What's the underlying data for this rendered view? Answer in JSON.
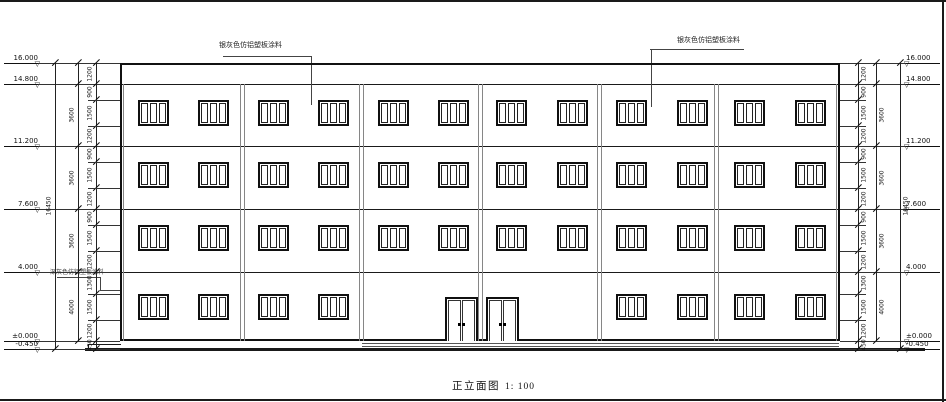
{
  "title": {
    "name": "正立面图",
    "scale": "1: 100"
  },
  "annotations": {
    "left": {
      "text": "银灰色仿铝塑板涂料"
    },
    "right": {
      "text": "银灰色仿铝塑板涂料"
    },
    "base": {
      "text": "深灰色仿铝塑板涂料"
    }
  },
  "colors": {
    "line": "#1a1a1a",
    "pilaster": "#868686",
    "ground": "#111111"
  },
  "levels_left": [
    {
      "label": "16.000",
      "y": 63
    },
    {
      "label": "14.800",
      "y": 84
    },
    {
      "label": "11.200",
      "y": 146
    },
    {
      "label": "7.600",
      "y": 209
    },
    {
      "label": "4.000",
      "y": 272
    },
    {
      "label": "±0.000",
      "y": 341
    },
    {
      "label": "-0.450",
      "y": 349
    }
  ],
  "levels_right": [
    {
      "label": "16.000",
      "y": 63
    },
    {
      "label": "14.800",
      "y": 84
    },
    {
      "label": "11.200",
      "y": 146
    },
    {
      "label": "7.600",
      "y": 209
    },
    {
      "label": "4.000",
      "y": 272
    },
    {
      "label": "±0.000",
      "y": 341
    },
    {
      "label": "-0.450",
      "y": 349
    }
  ],
  "dim_chains": [
    {
      "id": "left-inner",
      "side": "left",
      "x": 96,
      "ext": true,
      "bounds": [
        63,
        84,
        100,
        126,
        146,
        162,
        188,
        209,
        225,
        251,
        272,
        294,
        320,
        341,
        349
      ],
      "labels": [
        "1200",
        "900",
        "1500",
        "1200",
        "900",
        "1500",
        "1200",
        "900",
        "1500",
        "1200",
        "1300",
        "1500",
        "1200",
        "450"
      ]
    },
    {
      "id": "left-story",
      "side": "left",
      "x": 78,
      "bounds": [
        63,
        84,
        146,
        209,
        272,
        341
      ],
      "labels": [
        "",
        "3600",
        "3600",
        "3600",
        "4000"
      ]
    },
    {
      "id": "left-overall",
      "side": "left",
      "x": 55,
      "bounds": [
        63,
        349
      ],
      "labels": [
        "16450"
      ]
    },
    {
      "id": "right-inner",
      "side": "right",
      "x": 858,
      "ext": true,
      "bounds": [
        63,
        84,
        100,
        126,
        146,
        162,
        188,
        209,
        225,
        251,
        272,
        294,
        320,
        341,
        349
      ],
      "labels": [
        "1200",
        "900",
        "1500",
        "1200",
        "900",
        "1500",
        "1200",
        "900",
        "1500",
        "1200",
        "1300",
        "1500",
        "1200",
        "450"
      ]
    },
    {
      "id": "right-story",
      "side": "right",
      "x": 876,
      "bounds": [
        63,
        84,
        146,
        209,
        272,
        341
      ],
      "labels": [
        "",
        "3600",
        "3600",
        "3600",
        "4000"
      ]
    },
    {
      "id": "right-overall",
      "side": "right",
      "x": 900,
      "bounds": [
        63,
        349
      ],
      "labels": [
        "16450"
      ]
    }
  ],
  "facade": {
    "outline": {
      "x": 120,
      "y": 63,
      "w": 720,
      "h": 278
    },
    "inner_edge_lines": [
      123,
      836
    ],
    "pilasters_x": [
      242,
      361,
      480,
      599,
      716
    ],
    "pilaster_top": 84,
    "pilaster_bottom": 341,
    "window": {
      "w": 31,
      "h": 26,
      "panes": 3
    },
    "window_rows": [
      {
        "name": "floor-4",
        "y": 100,
        "cols": [
          138,
          198,
          258,
          318,
          378,
          438,
          496,
          557,
          616,
          677,
          734,
          795
        ]
      },
      {
        "name": "floor-3",
        "y": 162,
        "cols": [
          138,
          198,
          258,
          318,
          378,
          438,
          496,
          557,
          616,
          677,
          734,
          795
        ]
      },
      {
        "name": "floor-2",
        "y": 225,
        "cols": [
          138,
          198,
          258,
          318,
          378,
          438,
          496,
          557,
          616,
          677,
          734,
          795
        ]
      },
      {
        "name": "floor-1",
        "y": 294,
        "cols": [
          138,
          198,
          258,
          318,
          616,
          677,
          734,
          795
        ]
      }
    ],
    "doors": [
      {
        "x": 445,
        "y": 297,
        "w": 33,
        "h": 44
      },
      {
        "x": 486,
        "y": 297,
        "w": 33,
        "h": 44
      }
    ]
  },
  "lines": [
    {
      "n": "sheet-border-top",
      "x": 0,
      "y": 0,
      "w": 946,
      "h": 2
    },
    {
      "n": "sheet-border-right",
      "x": 942,
      "y": 0,
      "w": 2,
      "h": 402
    },
    {
      "n": "sheet-border-bottom",
      "x": 0,
      "y": 399,
      "w": 946,
      "h": 2
    },
    {
      "n": "parapet-band-line",
      "x": 121,
      "y": 84,
      "w": 718,
      "h": 1.2
    },
    {
      "n": "floor-line-3",
      "x": 121,
      "y": 146,
      "w": 718,
      "h": 1
    },
    {
      "n": "floor-line-2",
      "x": 121,
      "y": 209,
      "w": 718,
      "h": 1
    },
    {
      "n": "floor-line-1",
      "x": 121,
      "y": 272,
      "w": 718,
      "h": 1
    },
    {
      "n": "plinth-step-horizontal",
      "x": 88,
      "y": 344,
      "w": 33,
      "h": 1
    },
    {
      "n": "plinth-step-vertical",
      "x": 88,
      "y": 344,
      "w": 1,
      "h": 5
    },
    {
      "n": "entrance-platform-top",
      "x": 362,
      "y": 343,
      "w": 477,
      "h": 1,
      "c": "#555"
    },
    {
      "n": "entrance-platform-bottom",
      "x": 362,
      "y": 346,
      "w": 477,
      "h": 1,
      "c": "#555"
    },
    {
      "n": "ground-line",
      "x": 85,
      "y": 348,
      "w": 840,
      "h": 3
    },
    {
      "n": "leader-left-underline",
      "x": 223,
      "y": 56,
      "w": 89,
      "h": 1,
      "c": "#444"
    },
    {
      "n": "leader-left-vertical",
      "x": 311,
      "y": 56,
      "w": 1,
      "h": 49,
      "c": "#444"
    },
    {
      "n": "leader-right-underline",
      "x": 650,
      "y": 49,
      "w": 94,
      "h": 1,
      "c": "#444"
    },
    {
      "n": "leader-right-vertical",
      "x": 651,
      "y": 49,
      "w": 1,
      "h": 58,
      "c": "#444"
    },
    {
      "n": "leader-base-horizontal-1",
      "x": 57,
      "y": 277,
      "w": 44,
      "h": 1,
      "c": "#444"
    },
    {
      "n": "leader-base-vertical",
      "x": 100,
      "y": 277,
      "w": 1,
      "h": 14,
      "c": "#444"
    },
    {
      "n": "leader-base-horizontal-2",
      "x": 100,
      "y": 290,
      "w": 21,
      "h": 1,
      "c": "#444"
    }
  ]
}
